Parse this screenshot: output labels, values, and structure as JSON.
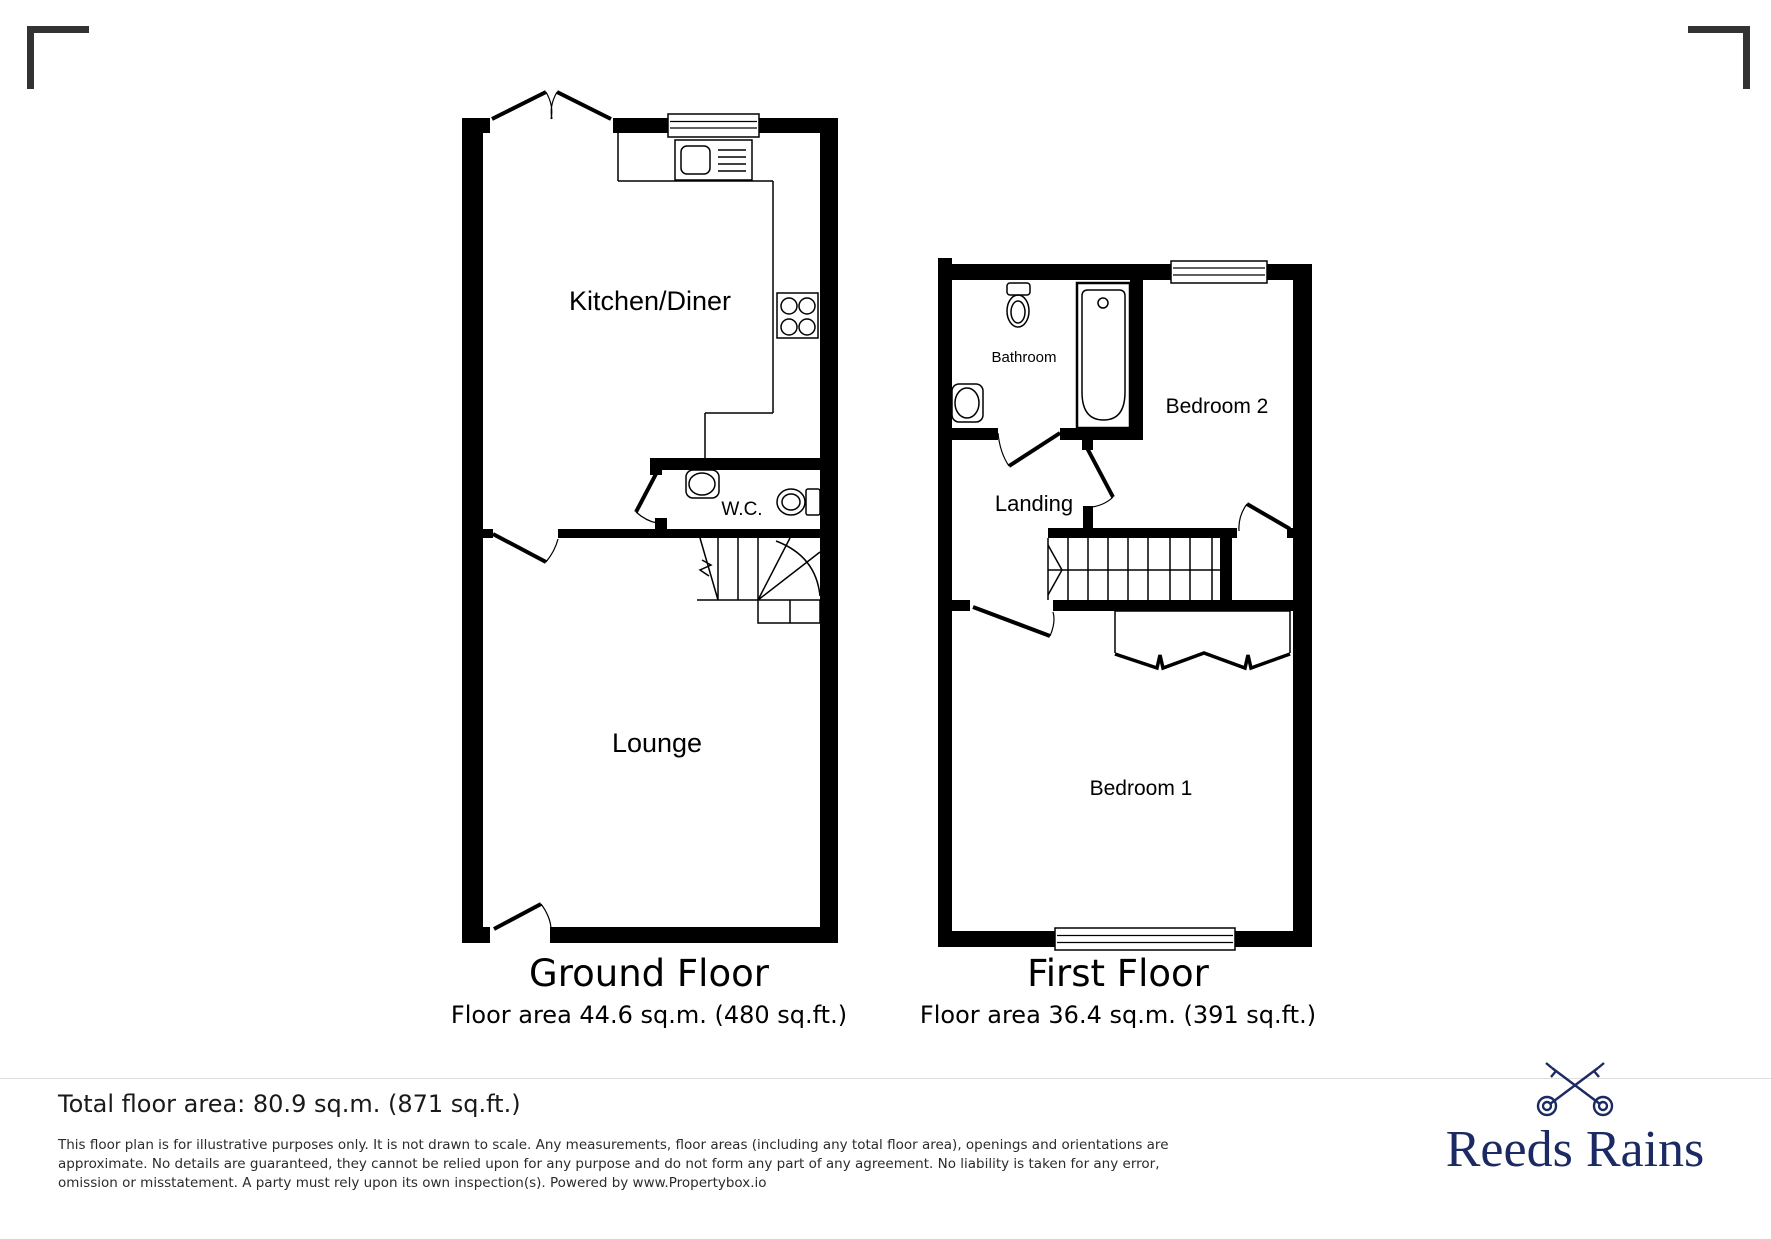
{
  "floors": [
    {
      "title": "Ground Floor",
      "area": "Floor area 44.6 sq.m. (480 sq.ft.)",
      "rooms": [
        {
          "label": "Kitchen/Diner"
        },
        {
          "label": "W.C."
        },
        {
          "label": "Lounge"
        }
      ],
      "fixtures": [
        "french-door-icon",
        "window-icon",
        "sink-drainer-icon",
        "hob-icon",
        "basin-icon",
        "toilet-icon",
        "stairs-icon",
        "door-icon"
      ]
    },
    {
      "title": "First Floor",
      "area": "Floor area 36.4 sq.m. (391 sq.ft.)",
      "rooms": [
        {
          "label": "Bathroom"
        },
        {
          "label": "Bedroom 2"
        },
        {
          "label": "Landing"
        },
        {
          "label": "Bedroom 1"
        }
      ],
      "fixtures": [
        "toilet-icon",
        "basin-icon",
        "bath-icon",
        "stairs-icon",
        "wardrobe-icon",
        "window-icon",
        "door-icon"
      ]
    }
  ],
  "footer": {
    "total_area": "Total floor area: 80.9 sq.m. (871 sq.ft.)",
    "disclaimer": "This floor plan is for illustrative purposes only. It is not drawn to scale. Any measurements, floor areas (including any total floor area), openings and orientations are approximate. No details are guaranteed, they cannot be relied upon for any purpose and do not form any part of any agreement. No liability is taken for any error, omission or misstatement. A party must rely upon its own inspection(s). Powered by www.Propertybox.io",
    "brand": "Reeds Rains"
  },
  "colors": {
    "wall": "#000000",
    "brand_navy": "#1b2a63",
    "crop_mark": "#333333"
  }
}
